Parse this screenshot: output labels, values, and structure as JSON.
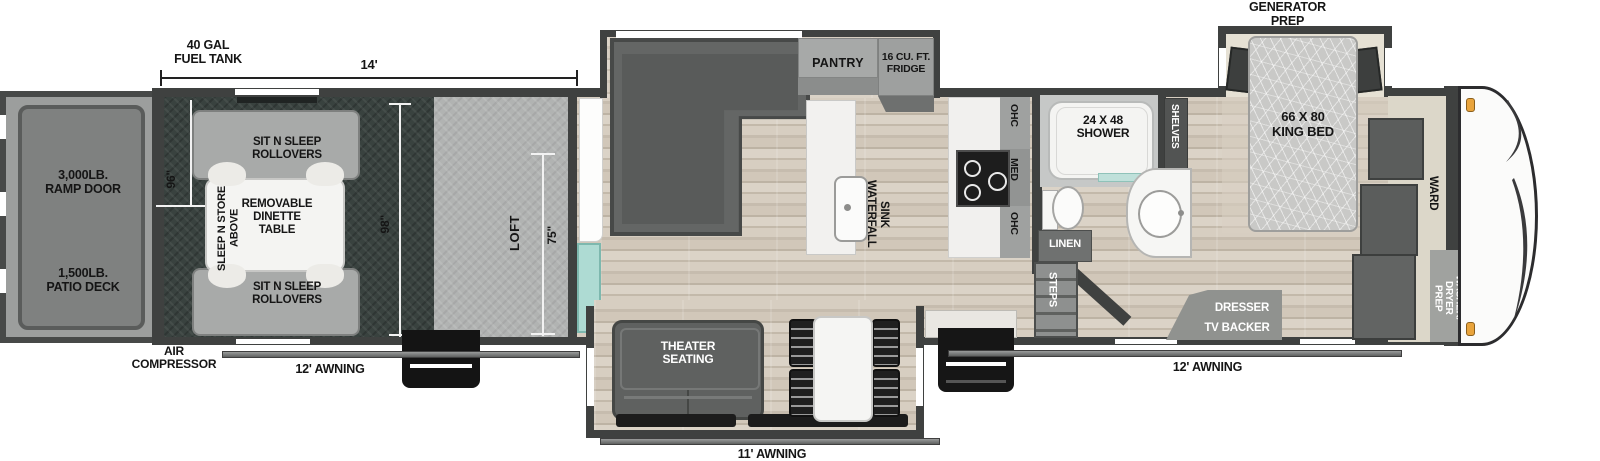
{
  "labels": {
    "fuel_tank": "40 GAL\nFUEL TANK",
    "dim_14": "14'",
    "ramp_door": "3,000LB.\nRAMP DOOR",
    "patio_deck": "1,500LB.\nPATIO DECK",
    "air_compressor": "AIR\nCOMPRESSOR",
    "awning_left": "12' AWNING",
    "awning_center": "11' AWNING",
    "awning_right": "12' AWNING",
    "dim_96": "96\"",
    "dim_98": "98\"",
    "dim_75": "75\"",
    "loft": "LOFT",
    "sit_n_sleep_top": "SIT N SLEEP\nROLLOVERS",
    "sit_n_sleep_bottom": "SIT N SLEEP\nROLLOVERS",
    "removable_dinette": "REMOVABLE\nDINETTE\nTABLE",
    "sleep_n_store": "SLEEP N STORE\nABOVE",
    "pantry": "PANTRY",
    "fridge": "16 CU. FT.\nFRIDGE",
    "waterfall_sink": "WATERFALL\nSINK",
    "theater_seating": "THEATER\nSEATING",
    "ohc_top": "OHC",
    "med": "MED",
    "ohc_bottom": "OHC",
    "shower": "24 X 48\nSHOWER",
    "shelves": "SHELVES",
    "linen": "LINEN",
    "steps": "STEPS",
    "generator_prep": "GENERATOR\nPREP",
    "king_bed": "66 X 80\nKING BED",
    "dresser": "DRESSER",
    "tv_backer": "TV BACKER",
    "ward": "WARD",
    "washer_dryer": "WASHER/\nDRYER\nPREP"
  },
  "colors": {
    "wall": "#3f4140",
    "wood_floor": "#cfc5b7",
    "garage_floor": "#39423f",
    "loft_floor": "#b1b3b2",
    "furniture_dark": "#5f6160",
    "accent_teal": "#aedbd3",
    "marker_orange": "#e9a43c",
    "label_text": "#151515",
    "dim_line": "#f2f2f2"
  }
}
